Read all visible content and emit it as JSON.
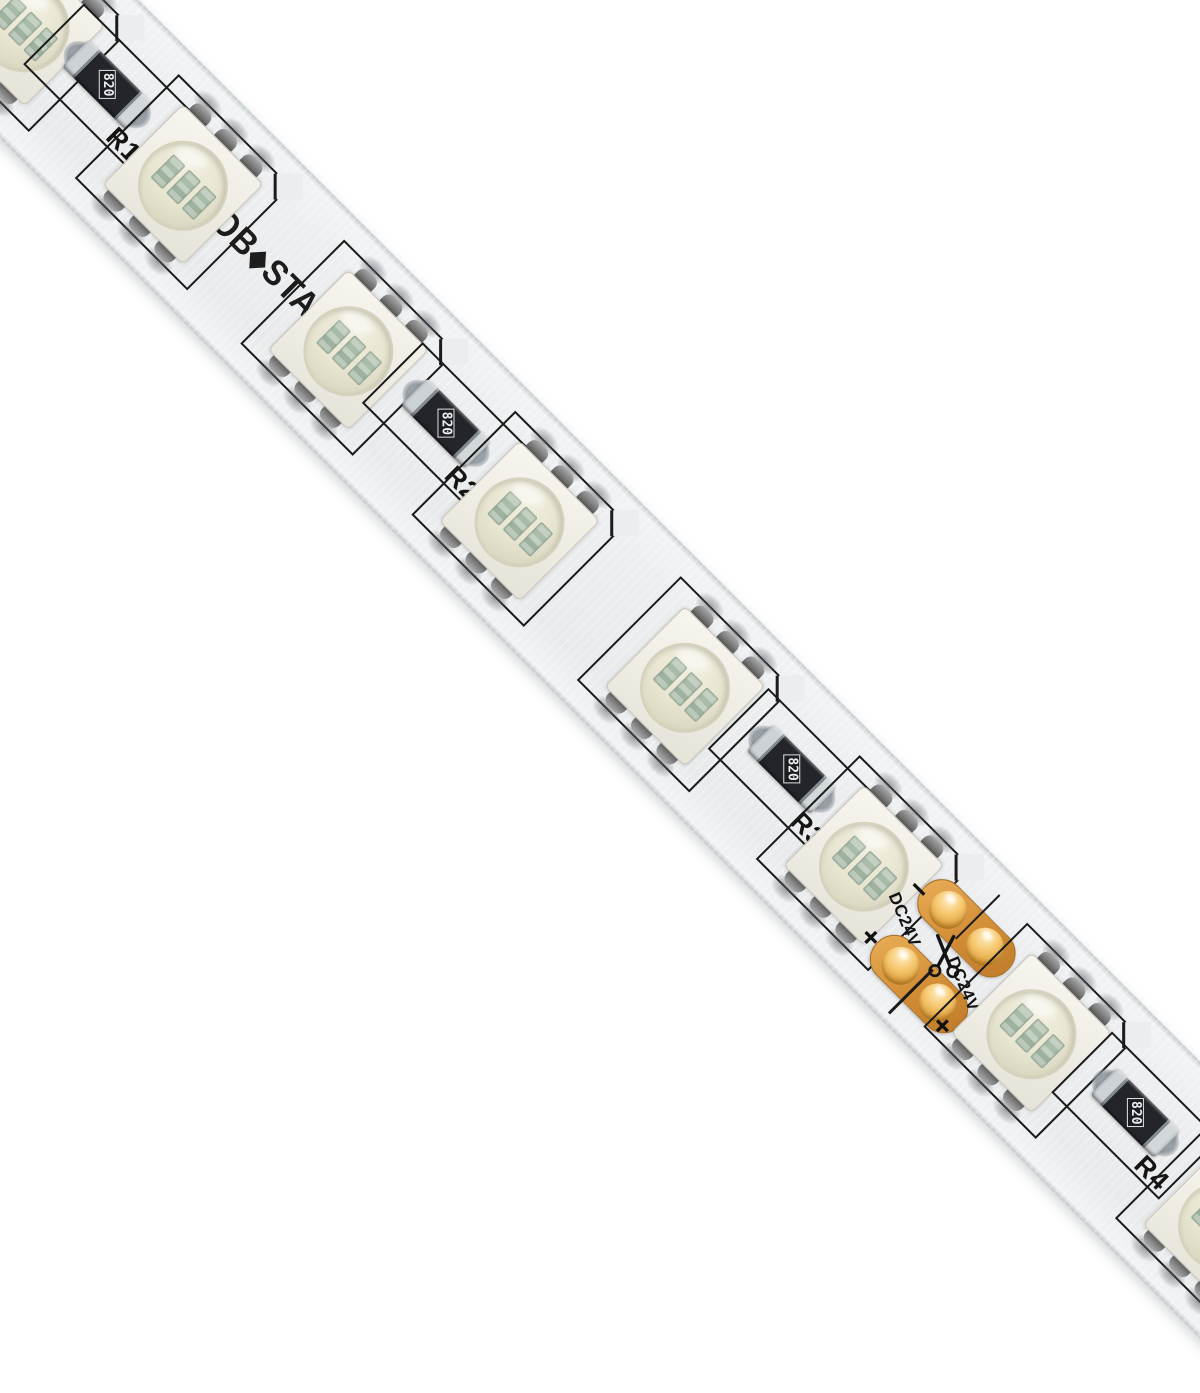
{
  "product": {
    "brand": {
      "prefix": "GLOB",
      "star": "◆",
      "suffix": "STAR",
      "full_name": "GLOBOSTAR"
    }
  },
  "strip": {
    "voltage_label": "DC24V",
    "polarity_plus": "+",
    "polarity_minus": "−",
    "resistor_marking": "820",
    "components": [
      {
        "type": "led",
        "s": 35
      },
      {
        "type": "resistor",
        "s": 136,
        "label": "R1"
      },
      {
        "type": "led",
        "s": 259
      },
      {
        "type": "led",
        "s": 493
      },
      {
        "type": "resistor",
        "s": 615,
        "label": "R2"
      },
      {
        "type": "led",
        "s": 735
      },
      {
        "type": "led",
        "s": 969
      },
      {
        "type": "resistor",
        "s": 1104,
        "label": "R3"
      },
      {
        "type": "led",
        "s": 1222
      },
      {
        "type": "cut",
        "s": 1340
      },
      {
        "type": "led",
        "s": 1459
      },
      {
        "type": "resistor",
        "s": 1590,
        "label": "R4"
      },
      {
        "type": "led",
        "s": 1730
      }
    ],
    "colors": {
      "background": "#ffffff",
      "pcb": "#ebedef",
      "silkscreen": "#1b1b1b",
      "copper_pad": "#d99a45",
      "resistor_body": "#24252b",
      "led_body": "#f2f0e7"
    }
  }
}
